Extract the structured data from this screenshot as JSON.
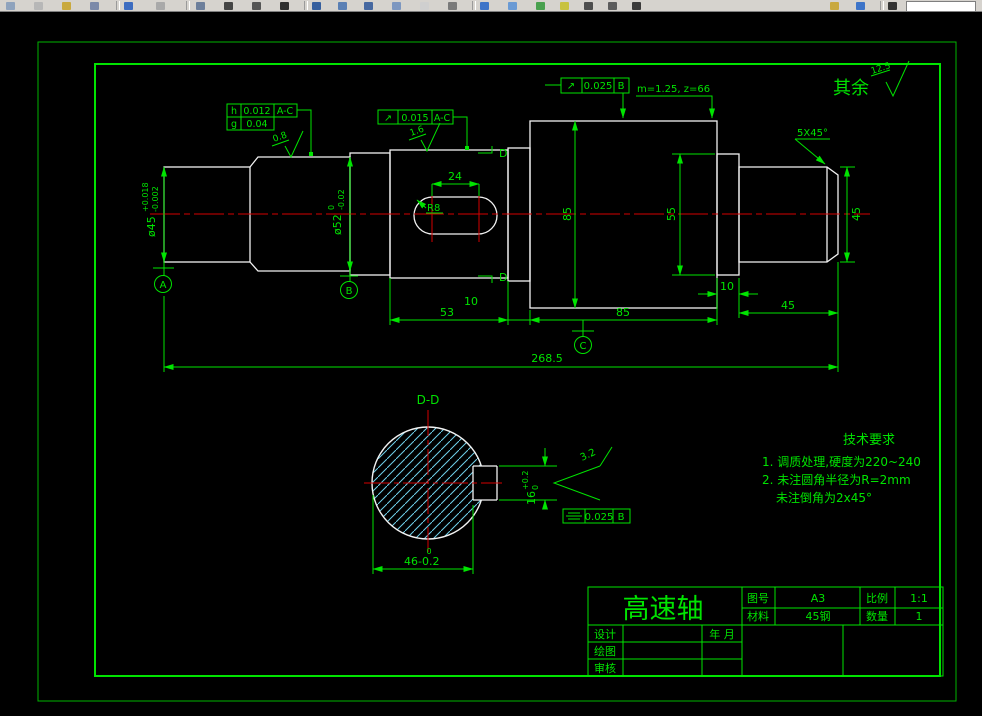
{
  "colors": {
    "green": "#00e400",
    "white": "#f2f2f2",
    "red": "#d40000",
    "hatch": "#6fd0ea",
    "bg": "#000000",
    "toolbar_bg": "#d6d3ce"
  },
  "surface_note": {
    "prefix": "其余",
    "value": "12.5"
  },
  "finishes": {
    "f08": "0.8",
    "f16": "1.6",
    "f32": "3.2"
  },
  "gear_note": "m=1.25, z=66",
  "chamfer_note": "5X45°",
  "fcf": {
    "top": {
      "sym": "↗",
      "tol": "0.025",
      "datum": "B"
    },
    "left_r1": {
      "sym": "h",
      "tol": "0.012",
      "datum": "A-C"
    },
    "left_r2": {
      "sym": "g",
      "tol": "0.04"
    },
    "mid": {
      "sym": "↗",
      "tol": "0.015",
      "datum": "A-C"
    },
    "section": {
      "tol": "0.025",
      "datum": "B"
    }
  },
  "dims": {
    "keyway_len": "24",
    "keyway_r": "R8",
    "d45l": {
      "base": "ø45",
      "up": "+0.018",
      "low": "-0.002"
    },
    "d52": {
      "base": "ø52",
      "up": "0",
      "low": "-0.02"
    },
    "d85": "85",
    "d55": "55",
    "d45r": "45",
    "l53": "53",
    "l10a": "10",
    "l85": "85",
    "l10b": "10",
    "l45": "45",
    "total": "268.5",
    "w46": {
      "up": "0",
      "base": "46-0.2"
    },
    "w16": {
      "base": "16",
      "up": "+0.2",
      "low": "0"
    }
  },
  "datums": {
    "a": "A",
    "b": "B",
    "c": "C"
  },
  "section_view": {
    "label": "D-D",
    "cut": "D"
  },
  "tech": {
    "title": "技术要求",
    "line1": "1. 调质处理,硬度为220~240",
    "line2": "2. 未注圆角半径为R=2mm",
    "line3": "未注倒角为2x45°"
  },
  "titleblock": {
    "part": "高速轴",
    "no_label": "图号",
    "no_value": "A3",
    "scale_label": "比例",
    "scale_value": "1:1",
    "mat_label": "材料",
    "mat_value": "45钢",
    "qty_label": "数量",
    "qty_value": "1",
    "row_design": "设计",
    "row_draw": "绘图",
    "row_check": "审核",
    "date_label": "年 月"
  }
}
